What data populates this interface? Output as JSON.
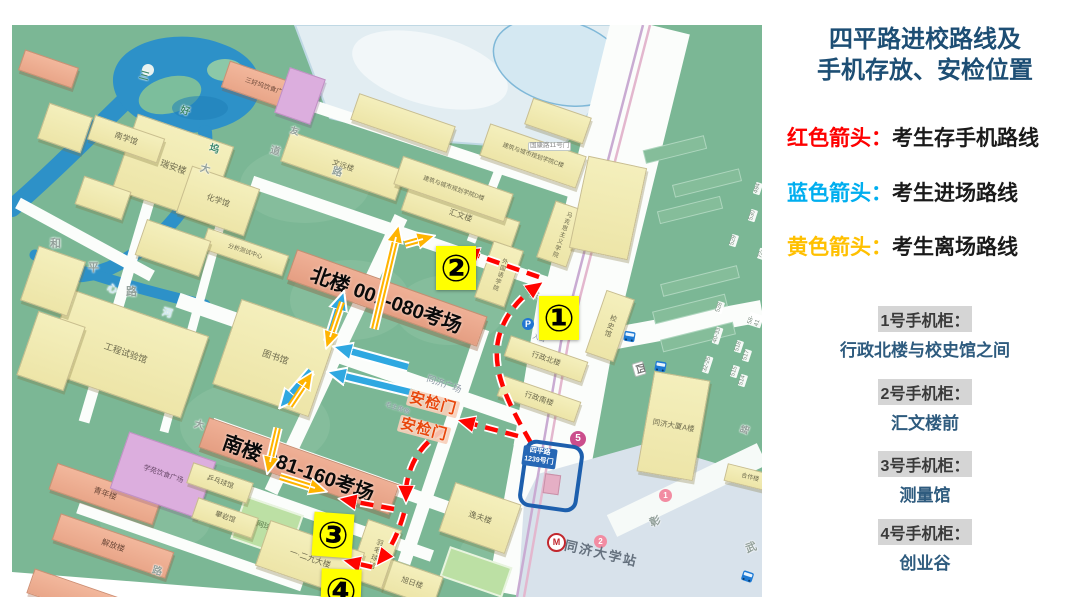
{
  "panel": {
    "title_line1": "四平路进校路线及",
    "title_line2": "手机存放、安检位置",
    "legend": [
      {
        "label": "红色箭头：",
        "desc": "考生存手机路线",
        "color": "#FE0000"
      },
      {
        "label": "蓝色箭头：",
        "desc": "考生进场路线",
        "color": "#00AEEF"
      },
      {
        "label": "黄色箭头：",
        "desc": "考生离场路线",
        "color": "#FFC000"
      }
    ],
    "cabinets": [
      {
        "label": "1号手机柜：",
        "location": "行政北楼与校史馆之间"
      },
      {
        "label": "2号手机柜：",
        "location": "汇文楼前"
      },
      {
        "label": "3号手机柜：",
        "location": "测量馆"
      },
      {
        "label": "4号手机柜：",
        "location": "创业谷"
      }
    ]
  },
  "map": {
    "exam_rooms": [
      "北楼 001-080考场",
      "南楼 081-160考场"
    ],
    "security_gates": [
      "安检门",
      "安检门"
    ],
    "phone_markers": [
      "①",
      "②",
      "③",
      "④"
    ],
    "gate": {
      "line1": "四平路",
      "line2": "1239号门"
    },
    "station": {
      "name": "同济大学站",
      "line_badge": "5",
      "exits": [
        "1",
        "2"
      ],
      "metro_mark": "M"
    },
    "parking_icon": "P",
    "buildings": [
      "汇文楼",
      "图书馆",
      "行政北楼",
      "行政南楼",
      "校史馆",
      "逸夫楼",
      "旭日楼",
      "羽毛球馆",
      "一·二九大楼",
      "瑞安楼",
      "南学馆",
      "工程试验馆",
      "同济大厦A楼",
      "青年楼",
      "解放楼",
      "学苑饮食广场",
      "乒乓球馆",
      "攀岩馆",
      "网球场",
      "三好坞饮食广场",
      "文远楼",
      "建筑与城市规划学院C楼",
      "建筑与城市规划学院D楼",
      "马克思主义学院",
      "外国语学院",
      "合作楼",
      "化学馆",
      "分析测试中心"
    ],
    "place_labels": [
      "同济广场",
      "毛主席像",
      "国康路11号门",
      "入口"
    ],
    "road_labels": [
      "和",
      "平",
      "路",
      "心",
      "河",
      "三",
      "好",
      "坞",
      "大",
      "道",
      "路",
      "东",
      "友",
      "四",
      "彰",
      "武",
      "路",
      "大",
      "路"
    ],
    "block_numbers": [
      "494",
      "530",
      "529",
      "72-6",
      "528",
      "58-41",
      "40-33",
      "518",
      "517",
      "32-25",
      "515",
      "514"
    ]
  },
  "colors": {
    "red_route": "#FF0400",
    "blue_route": "#2FA8E1",
    "yellow_route": "#FFB400",
    "title_blue": "#1D4E74",
    "marker_bg": "#FFFF00"
  }
}
